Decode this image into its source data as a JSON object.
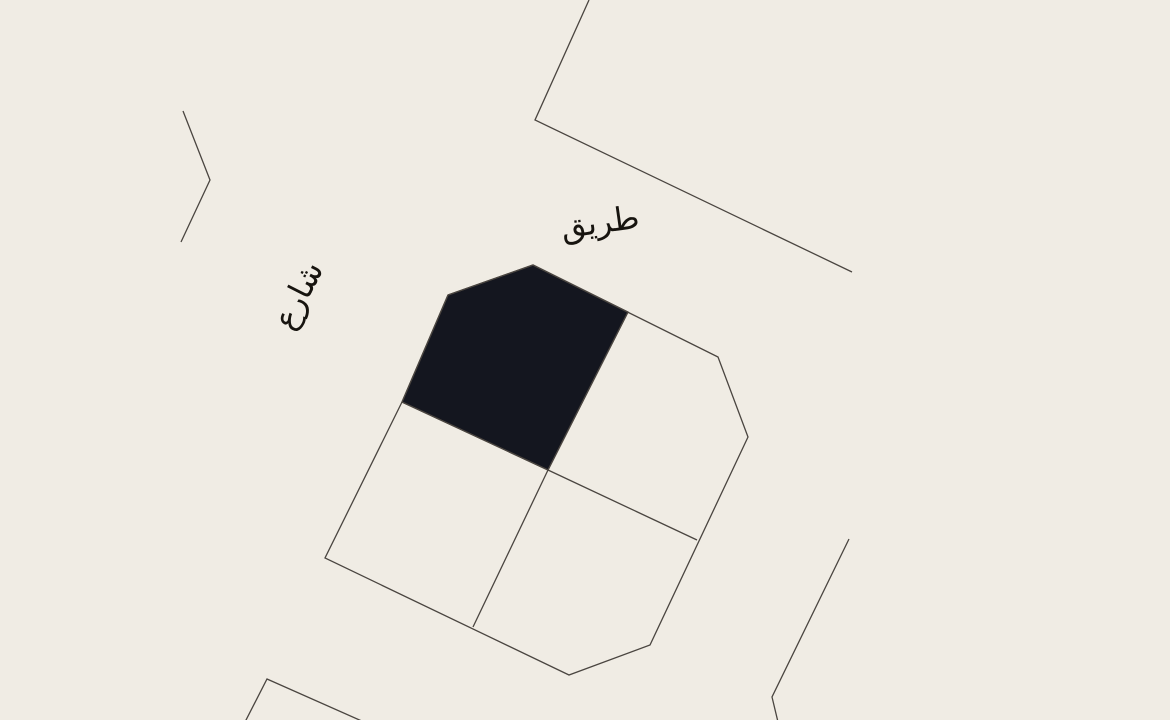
{
  "map": {
    "background_color": "#f0ece4",
    "line_color": "#4a4540",
    "line_width": 1.3,
    "text_color": "#17140f",
    "highlight_color": "#14161f",
    "labels": [
      {
        "name": "road-label",
        "text": "طريق",
        "x": 600,
        "y": 222,
        "rotation": -8,
        "font_size": 32
      },
      {
        "name": "street-label",
        "text": "شارع",
        "x": 298,
        "y": 295,
        "rotation": -63,
        "font_size": 32
      }
    ],
    "shapes": [
      {
        "name": "road-line",
        "type": "polyline",
        "points": "589,0 535,120 852,272"
      },
      {
        "name": "boundary-chevron-west",
        "type": "polyline",
        "points": "183,111 210,180 181,242"
      },
      {
        "name": "selected-parcel",
        "type": "polygon",
        "points": "448,295 533,265 628,312 548,470 402,402",
        "fill": true,
        "interactable": true
      },
      {
        "name": "block-outline",
        "type": "polygon",
        "points": "533,265 718,357 748,437 650,645 569,675 325,558 402,402 448,295"
      },
      {
        "name": "parcel-divider-northeast",
        "type": "polyline",
        "points": "628,312 548,470"
      },
      {
        "name": "parcel-divider-west",
        "type": "polyline",
        "points": "402,402 548,470"
      },
      {
        "name": "parcel-divider-east",
        "type": "polyline",
        "points": "548,470 697,540"
      },
      {
        "name": "parcel-divider-south",
        "type": "polyline",
        "points": "548,470 473,627"
      },
      {
        "name": "boundary-southeast",
        "type": "polyline",
        "points": "849,539 772,697 778,722"
      },
      {
        "name": "boundary-southwest",
        "type": "polyline",
        "points": "245,722 267,679 364,722"
      }
    ]
  }
}
